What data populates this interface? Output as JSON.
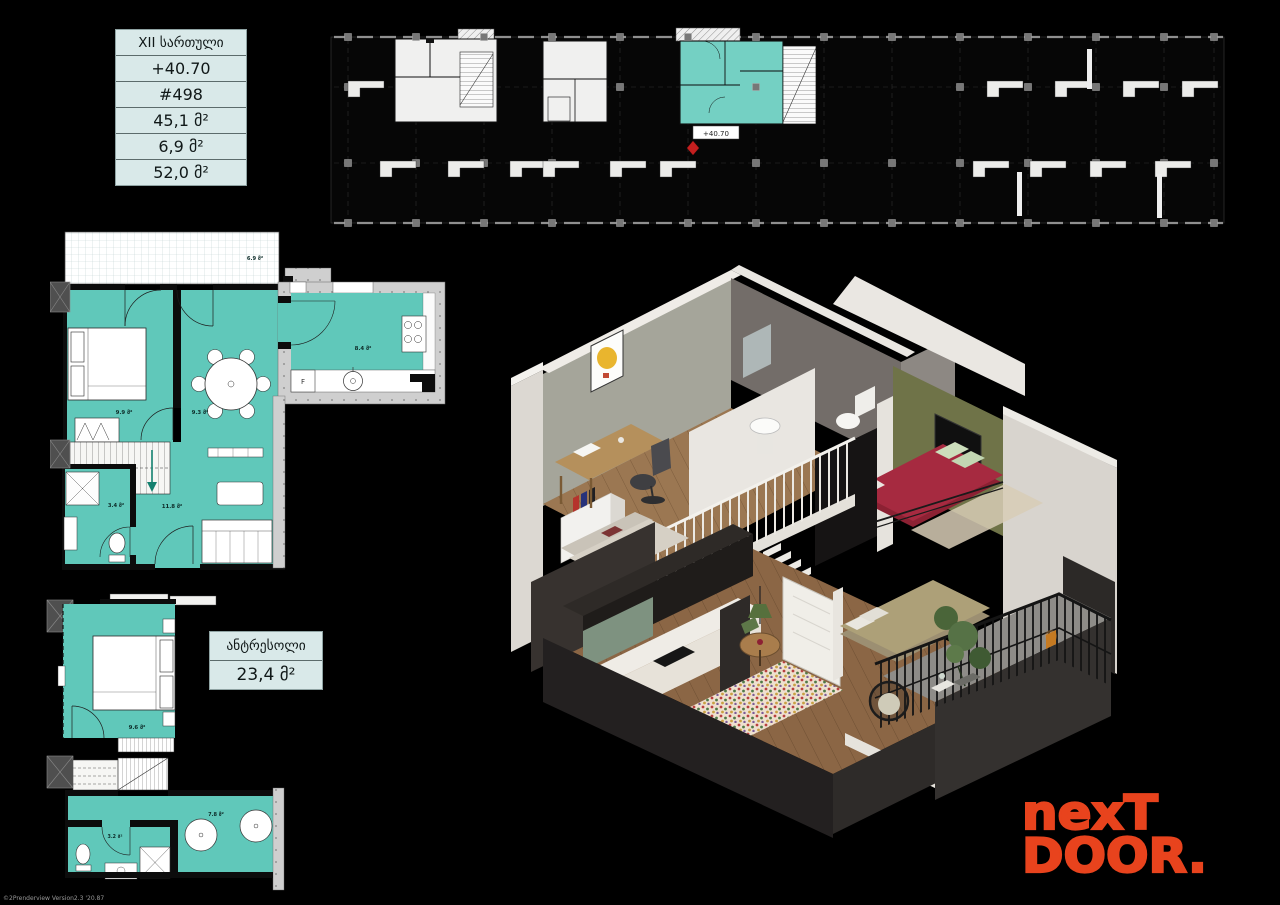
{
  "colors": {
    "teal": "#60c8ba",
    "key_plan_teal": "#74d0c3",
    "table_bg": "#d9e9e9",
    "logo_orange": "#e8431d",
    "marker_red": "#c41f1f"
  },
  "info_table": {
    "floor_label": "XII სართული",
    "elevation": "+40.70",
    "unit_number": "#498",
    "living_area": "45,1 მ²",
    "balcony_area": "6,9 მ²",
    "total_area": "52,0 მ²"
  },
  "key_plan": {
    "unit_elevation_label": "+40.70"
  },
  "main_plan": {
    "balcony": "6.9 მ²",
    "bedroom": "9.9 მ²",
    "dining": "9.3 მ²",
    "kitchen": "8.4 მ²",
    "bathroom": "3.4 მ²",
    "living": "11.8 მ²",
    "fridge": "F"
  },
  "mezzanine_box": {
    "title": "ანტრესოლი",
    "area": "23,4 მ²"
  },
  "mezzanine_plan": {
    "bedroom": "9.6 მ²",
    "bathroom": "3.2 მ²",
    "hall": "7.8 მ²"
  },
  "logo": {
    "line1": "nexT",
    "line2": "DOOR."
  },
  "fine_print": "©2Prenderview Version2.3 '20.87"
}
